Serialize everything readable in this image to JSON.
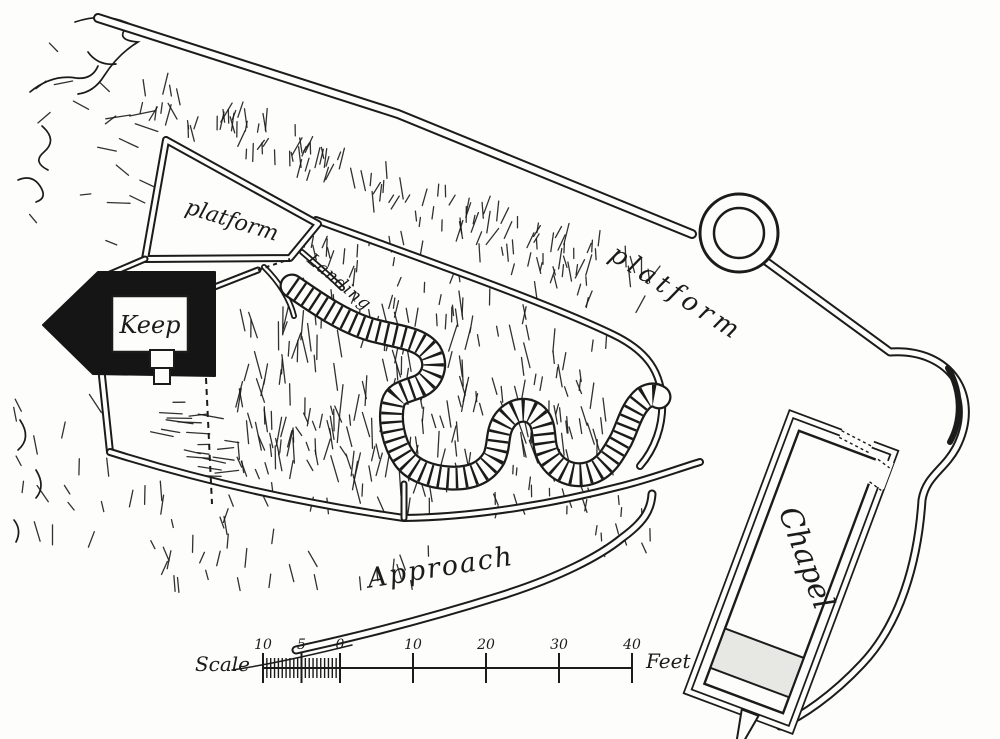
{
  "figure": {
    "type": "castle-site-plan",
    "labels": {
      "platform_upper": "platform",
      "platform_right": "platform",
      "keep": "Keep",
      "landing": "Landing",
      "approach": "Approach",
      "chapel": "Chapel"
    },
    "scale_bar": {
      "label": "Scale",
      "unit": "Feet",
      "tick_labels": [
        "10",
        "5",
        "0",
        "10",
        "20",
        "30",
        "40"
      ]
    },
    "colors": {
      "ink": "#1b1b1b",
      "paper": "#fdfdfc",
      "keep_fill": "#151515",
      "chapel_shade": "#e7e7e3"
    }
  }
}
